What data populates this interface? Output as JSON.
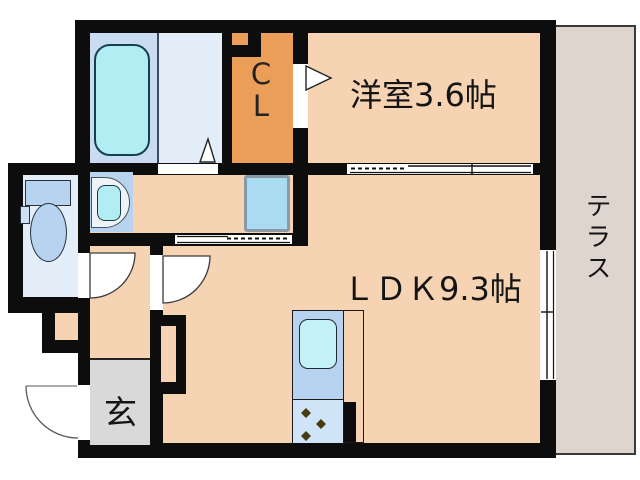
{
  "floorplan": {
    "rooms": {
      "western_room": {
        "label": "洋室3.6帖",
        "area_tatami": "3.6"
      },
      "ldk": {
        "label": "ＬＤＫ9.3帖",
        "area_tatami": "9.3"
      },
      "closet": {
        "line1": "C",
        "line2": "L"
      },
      "terrace": {
        "label": "テラス"
      },
      "entrance": {
        "label": "玄"
      }
    },
    "fixtures": [
      "bathtub",
      "toilet",
      "washbasin",
      "washing-machine-space",
      "kitchen-sink",
      "stove-burners"
    ],
    "colors": {
      "wall": "#0d0d0d",
      "room_floor_peach": "#f5d3b3",
      "closet_orange": "#eb9e58",
      "bath_tub_zone_blue": "#c9dcf2",
      "bath_floor_blue": "#e4eef9",
      "fixture_blue": "#b7d3f0",
      "water_cyan": "#b2edf4",
      "terrace_gray": "#ded5ce",
      "entrance_gray": "#d9d9d9",
      "washer_space_blue": "#a9dcf0",
      "stove_zone_blue": "#cfe4f6",
      "burner_brown": "#4a3a10"
    }
  }
}
